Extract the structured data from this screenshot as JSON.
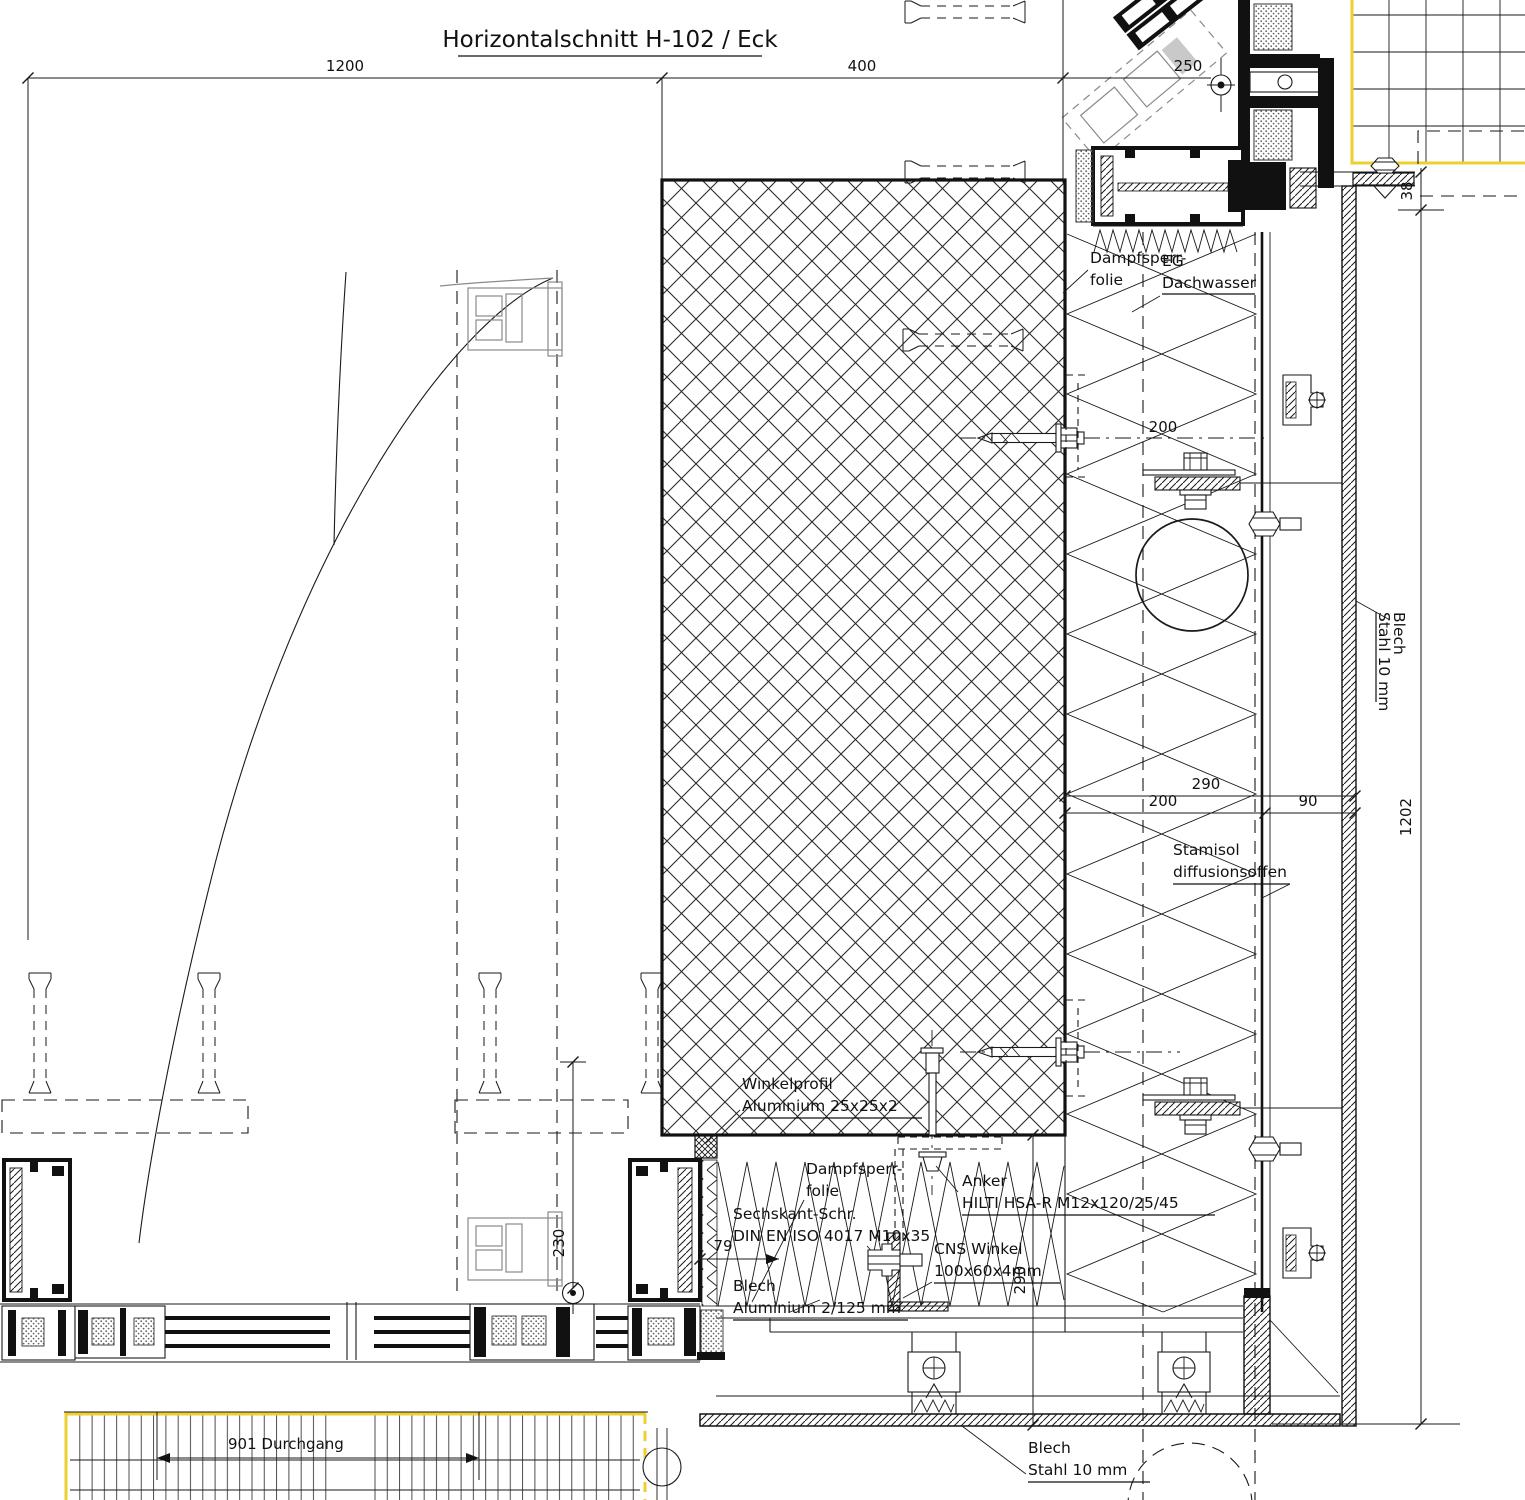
{
  "title": "Horizontalschnitt H-102 / Eck",
  "colors": {
    "line": "#1a1a1a",
    "highlight_yellow": "#eecf30",
    "light_profile_gray": "#8a8a8a"
  },
  "dims": {
    "d1200": "1200",
    "d400": "400",
    "d250": "250",
    "d38": "38",
    "d1202": "1202",
    "d200a": "200",
    "d290a": "290",
    "d200b": "200",
    "d90": "90",
    "d230": "230",
    "d79": "79",
    "d290b": "290",
    "d901": "901 Durchgang"
  },
  "labels": {
    "dampfsperr_top": {
      "l1": "Dampfsperr-",
      "l2": "folie"
    },
    "eg": {
      "l1": "EG",
      "l2": "Dachwasser"
    },
    "blech_stahl_right": {
      "l1": "Blech",
      "l2": "Stahl 10 mm"
    },
    "stamisol": {
      "l1": "Stamisol",
      "l2": "diffusionsoffen"
    },
    "winkelprofil": {
      "l1": "Winkelprofil",
      "l2": "Aluminium 25x25x2"
    },
    "dampfsperr_bottom": {
      "l1": "Dampfsperr-",
      "l2": "folie"
    },
    "anker": {
      "l1": "Anker",
      "l2": "HILTI HSA-R M12x120/25/45"
    },
    "sechskant": {
      "l1": "Sechskant-Schr.",
      "l2": "DIN EN ISO 4017 M10x35"
    },
    "cns": {
      "l1": "CNS Winkel",
      "l2": "100x60x4mm"
    },
    "blech_alu": {
      "l1": "Blech",
      "l2": "Aluminium 2/125 mm"
    },
    "blech_stahl_bottom": {
      "l1": "Blech",
      "l2": "Stahl 10 mm"
    }
  }
}
